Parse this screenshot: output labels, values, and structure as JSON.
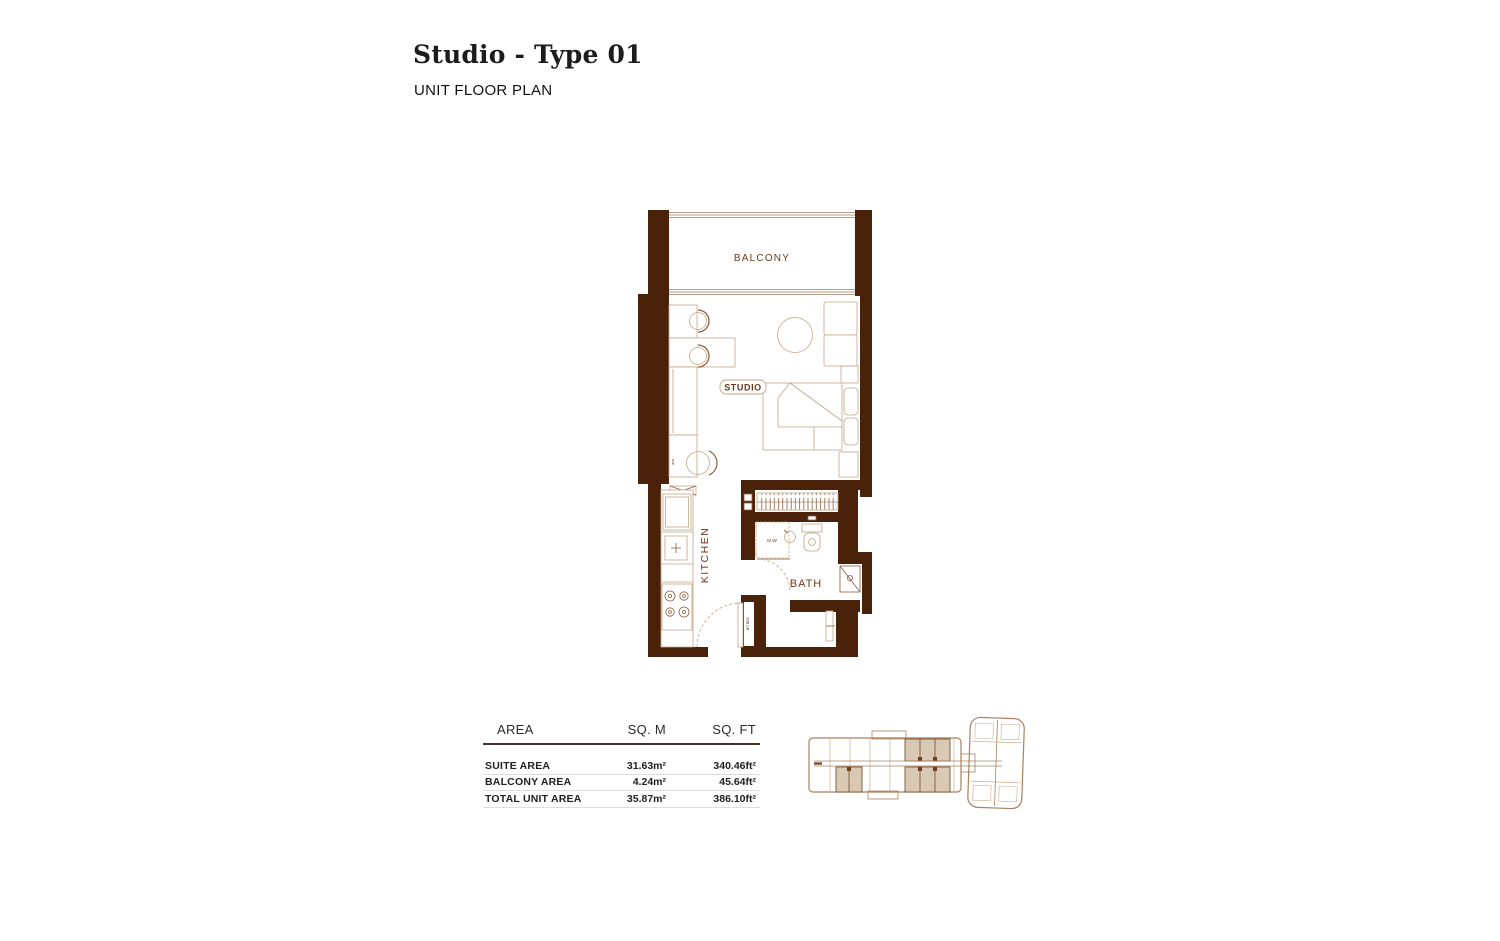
{
  "header": {
    "title": "Studio - Type 01",
    "subtitle": "UNIT FLOOR PLAN"
  },
  "floor_plan": {
    "room_labels": {
      "balcony": "BALCONY",
      "studio": "STUDIO",
      "kitchen": "KITCHEN",
      "bath": "BATH"
    },
    "small_labels": {
      "microwave": "M.W",
      "shaft": "JET BOX",
      "washer": "W.M"
    },
    "colors": {
      "wall": "#4A2109",
      "furniture_line": "#C2A686",
      "furniture_accent": "#8B5E3C",
      "label_text": "#6B3A1D"
    }
  },
  "area_table": {
    "columns": {
      "area": "AREA",
      "sqm": "SQ. M",
      "sqft": "SQ. FT"
    },
    "rows": [
      {
        "label": "SUITE AREA",
        "sqm": "31.63m²",
        "sqft": "340.46ft²"
      },
      {
        "label": "BALCONY AREA",
        "sqm": "4.24m²",
        "sqft": "45.64ft²"
      },
      {
        "label": "TOTAL UNIT AREA",
        "sqm": "35.87m²",
        "sqft": "386.10ft²"
      }
    ]
  },
  "key_plan": {
    "highlight_color": "#D9C8B4",
    "outline_color": "#A8825F"
  }
}
